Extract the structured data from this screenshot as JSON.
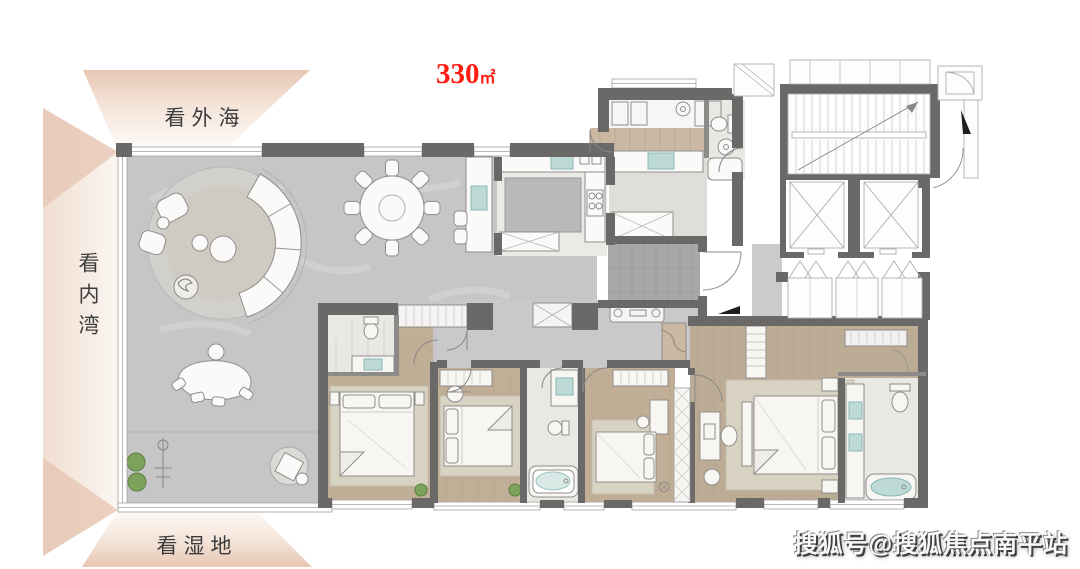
{
  "header": {
    "area": {
      "value": "330",
      "unit": "㎡"
    }
  },
  "view_labels": {
    "top": "看外海",
    "left": "看内湾",
    "bottom": "看湿地"
  },
  "watermark": "搜狐号@搜狐焦点南平站",
  "colors": {
    "area_red": "#fe1c10",
    "wall_dark": "#6b6967",
    "marble_floor": "#c6c6c8",
    "wood_floor": "#c1ae96",
    "foyer_tile": "#a8a8aa",
    "fixture_teal": "#bedad6",
    "plant_green": "#7da25b",
    "panel_tan": "#e7c6b4"
  }
}
